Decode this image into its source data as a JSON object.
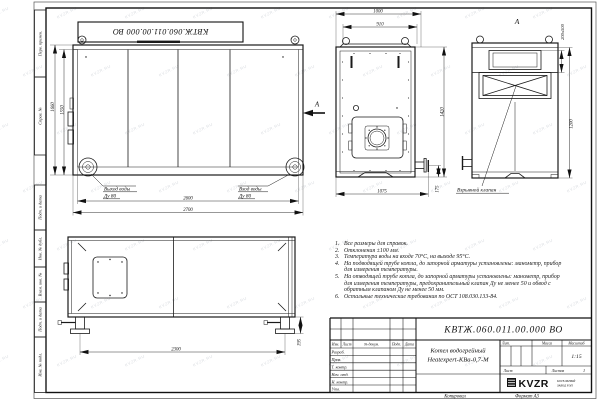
{
  "sheet": {
    "top_stamp": "КВТЖ.060.011.00.000 ВО",
    "watermark": "KVZR.RU",
    "side_labels": [
      "Перв. примен.",
      "Справ. №",
      "Подп. и дата",
      "Инв. № дубл.",
      "Взам. инв. №",
      "Подп. и дата",
      "Инв. № подл."
    ],
    "footer": {
      "copied_label": "Копировал",
      "format_label": "Формат А3"
    }
  },
  "views": {
    "side": {
      "dim_height_outer": "1660",
      "dim_height_inner": "1550",
      "dim_width_inner": "2600",
      "dim_width_outer": "2700",
      "outlet_line1": "Выход воды",
      "outlet_line2": "Ду 80",
      "inlet_line1": "Вход воды",
      "inlet_line2": "Ду 80",
      "view_arrow": "А"
    },
    "front": {
      "dim_top_outer": "1000",
      "dim_top_inner": "910",
      "dim_height": "1420",
      "dim_bottom": "1075",
      "dim_flange": "175"
    },
    "rear": {
      "label": "А",
      "dim_valve": "200х500",
      "dim_height": "1200",
      "valve_label": "Взрывной клапан"
    },
    "top": {
      "dim_length": "2300",
      "dim_feet": "195"
    }
  },
  "notes": [
    {
      "n": "1.",
      "t": "Все размеры для справок."
    },
    {
      "n": "2.",
      "t": "Отклонения ±100 мм."
    },
    {
      "n": "3.",
      "t": "Температура воды на входе 70°С, на выходе 95°С."
    },
    {
      "n": "4.",
      "t": "На подводящей трубе котла, до запорной арматуры установлены: манометр, прибор для измерения температуры."
    },
    {
      "n": "5.",
      "t": "На отводящей трубе котла, до запорной арматуры установлены: манометр, прибор для измерения температуры, предохранительный клапан Ду не менее 50 и обвод с обратным клапаном Ду не менее 50 мм."
    },
    {
      "n": "6.",
      "t": "Остальные технические требования по ОСТ 108.030.133-84."
    }
  ],
  "title_block": {
    "doc_number": "КВТЖ.060.011.00.000 ВО",
    "product_line1": "Котел водогрейный",
    "product_line2": "Heatexpert-КВа-0,7-М",
    "col_headers": {
      "izm": "Изм.",
      "list": "Лист",
      "doc": "№ докум.",
      "sign": "Подп.",
      "date": "Дата"
    },
    "rows": [
      "Разраб.",
      "Пров.",
      "Т. контр.",
      "Нач. отд.",
      "Н. контр.",
      "Утв."
    ],
    "lit_label": "Лит.",
    "mass_label": "Масса",
    "scale_label": "Масштаб",
    "scale_value": "1:15",
    "sheet_label": "Лист",
    "sheets_label": "Листов",
    "sheets_value": "1",
    "logo_text": "KVZR",
    "logo_sub1": "КОТЕЛЬНЫЙ",
    "logo_sub2": "ЗАВОД РЭП"
  }
}
